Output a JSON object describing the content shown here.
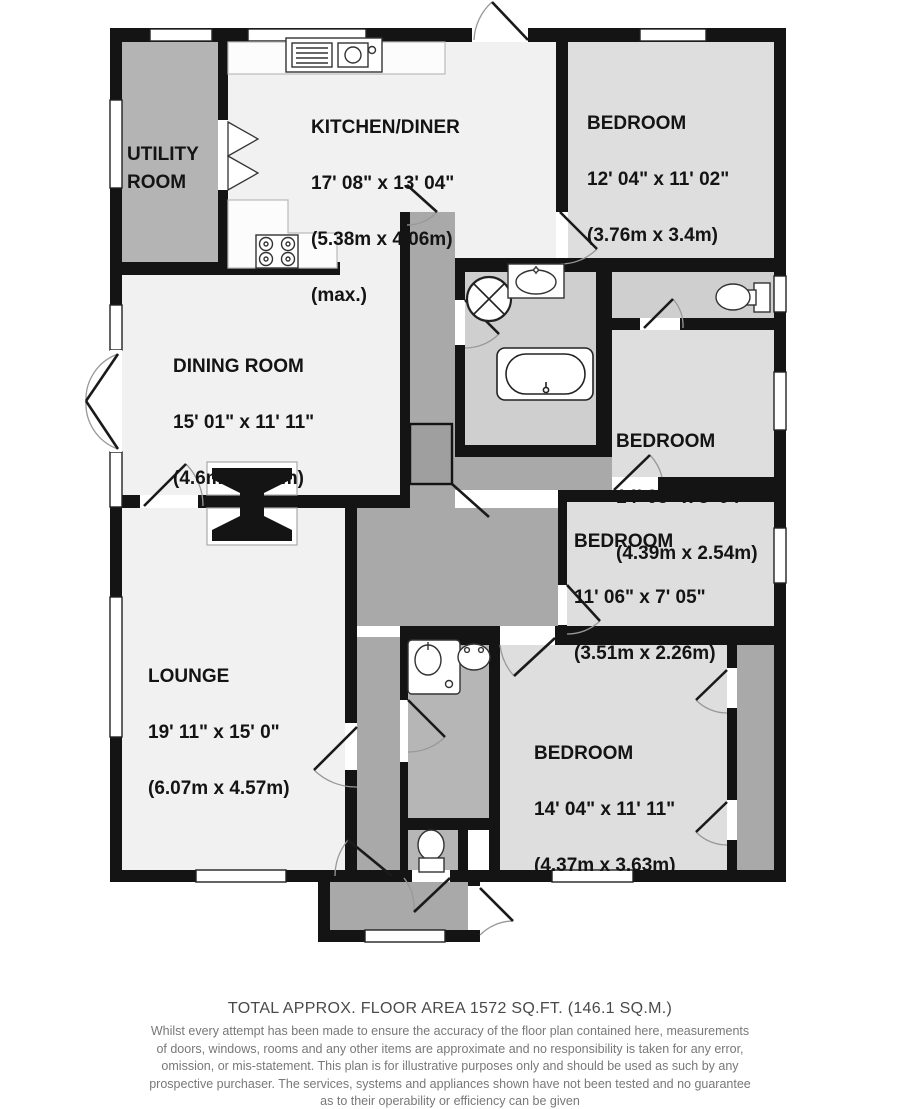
{
  "rooms": {
    "utility": {
      "name": "UTILITY\nROOM"
    },
    "kitchen": {
      "name": "KITCHEN/DINER",
      "imperial": "17' 08\" x 13' 04\"",
      "metric": "(5.38m x 4.06m)",
      "note": "(max.)"
    },
    "bedroom1": {
      "name": "BEDROOM",
      "imperial": "12' 04\" x 11' 02\"",
      "metric": "(3.76m x 3.4m)"
    },
    "dining": {
      "name": "DINING ROOM",
      "imperial": "15' 01\" x 11' 11\"",
      "metric": "(4.6m x 3.63m)"
    },
    "bedroom2": {
      "name": "BEDROOM",
      "imperial": "14' 05\" x 8' 04\"",
      "metric": "(4.39m x 2.54m)"
    },
    "bedroom3": {
      "name": "BEDROOM",
      "imperial": "11' 06\" x 7' 05\"",
      "metric": "(3.51m x 2.26m)"
    },
    "lounge": {
      "name": "LOUNGE",
      "imperial": "19' 11\" x 15' 0\"",
      "metric": "(6.07m x 4.57m)"
    },
    "bedroom4": {
      "name": "BEDROOM",
      "imperial": "14' 04\" x 11' 11\"",
      "metric": "(4.37m x 3.63m)"
    }
  },
  "footer": {
    "area": "TOTAL APPROX. FLOOR AREA 1572 SQ.FT. (146.1 SQ.M.)",
    "disclaimer": [
      "Whilst every attempt has been made to ensure the accuracy of the floor plan contained here, measurements",
      "of doors, windows, rooms and any other items are approximate and no responsibility is taken for any error,",
      "omission, or mis-statement. This plan is for illustrative purposes only and should be used as such by any",
      "prospective purchaser. The services, systems and appliances shown have not been tested and no guarantee",
      "as to their operability or efficiency can be given"
    ],
    "credit": "Made with Metropix ©2014"
  },
  "colors": {
    "wall": "#141414",
    "floor_light": "#f1f1f1",
    "floor_bedroom": "#dedede",
    "floor_bath": "#cfcfcf",
    "floor_utility": "#b4b4b4",
    "floor_hall": "#a9a9a9",
    "floor_ensuite": "#b6b6b6"
  }
}
